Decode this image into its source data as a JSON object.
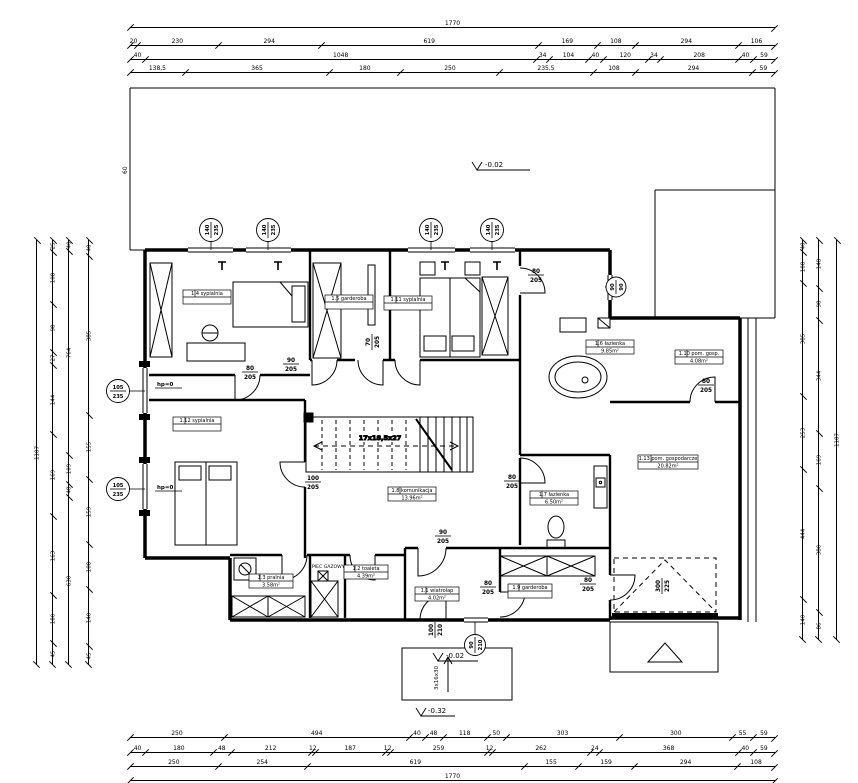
{
  "plan": {
    "rooms": [
      {
        "label": "1.4 sypialnia",
        "area": ""
      },
      {
        "label": "1.5 garderoba",
        "area": ""
      },
      {
        "label": "1.11 sypialnia",
        "area": ""
      },
      {
        "label": "1.6 łazienka",
        "area": "9.85m²"
      },
      {
        "label": "1.10 pom. gosp.",
        "area": "4.08m²"
      },
      {
        "label": "1.12 sypialnia",
        "area": ""
      },
      {
        "label": "1.8 komunikacja",
        "area": "13.96m²"
      },
      {
        "label": "1.7 łazienka",
        "area": "6.50m²"
      },
      {
        "label": "1.13 pom. gospodarcze",
        "area": "20.82m²"
      },
      {
        "label": "1.3 pralnia",
        "area": "3.58m²"
      },
      {
        "label": "1.2 toaleta",
        "area": "4.39m²"
      },
      {
        "label": "1.1 wiatrołap",
        "area": "4.02m²"
      },
      {
        "label": "1.9 garderoba",
        "area": ""
      }
    ],
    "doors": [
      {
        "top": "80",
        "bot": "205"
      },
      {
        "top": "90",
        "bot": "205"
      },
      {
        "top": "80",
        "bot": "205"
      },
      {
        "top": "80",
        "bot": "205"
      },
      {
        "top": "80",
        "bot": "205"
      },
      {
        "top": "100",
        "bot": "205"
      },
      {
        "top": "90",
        "bot": "205"
      },
      {
        "top": "80",
        "bot": "205"
      },
      {
        "top": "80",
        "bot": "205"
      },
      {
        "top": "70",
        "bot": "205"
      },
      {
        "top": "100",
        "bot": "210"
      },
      {
        "top": "300",
        "bot": "225"
      }
    ],
    "windows": [
      {
        "top": "140",
        "bot": "235"
      },
      {
        "top": "140",
        "bot": "235"
      },
      {
        "top": "140",
        "bot": "235"
      },
      {
        "top": "140",
        "bot": "235"
      },
      {
        "top": "105",
        "bot": "235"
      },
      {
        "top": "105",
        "bot": "235"
      },
      {
        "top": "90",
        "bot": "210"
      },
      {
        "top": "90",
        "bot": "90"
      }
    ],
    "levels": {
      "terrace": "-0.02",
      "entry": "-0.02",
      "outside": "-0.32"
    },
    "misc": {
      "stairs": "17x18,5x27",
      "steps": "3x16x30",
      "furnace": "PIEC GAZOWY",
      "hp": "hp=0",
      "dim60": "60"
    }
  },
  "dims": {
    "top": [
      [
        "1770"
      ],
      [
        "20",
        "230",
        "294",
        "619",
        "169",
        "108",
        "294",
        "106"
      ],
      [
        "40",
        "1048",
        "34",
        "104",
        "40",
        "120",
        "34",
        "208",
        "40",
        "59"
      ],
      [
        "138,5",
        "365",
        "180",
        "250",
        "235,5",
        "108",
        "294",
        "59"
      ]
    ],
    "bottom": [
      [
        "250",
        "494",
        "40",
        "48",
        "118",
        "50",
        "303",
        "300",
        "55",
        "59"
      ],
      [
        "40",
        "180",
        "48",
        "212",
        "12",
        "187",
        "12",
        "259",
        "12",
        "262",
        "24",
        "368",
        "40",
        "59"
      ],
      [
        "250",
        "254",
        "619",
        "155",
        "159",
        "294",
        "108"
      ],
      [
        "1770"
      ]
    ],
    "left": [
      [
        "1107"
      ],
      [
        "25",
        "108",
        "98",
        "27",
        "144",
        "169",
        "163",
        "100",
        "45"
      ],
      [
        "40",
        "764",
        "109",
        "48",
        "630"
      ],
      [
        "40",
        "385",
        "155",
        "159",
        "108",
        "140",
        "45"
      ]
    ],
    "right": [
      [
        "40",
        "108",
        "385",
        "253",
        "444",
        "140"
      ],
      [
        "148",
        "98",
        "344",
        "169",
        "380",
        "86"
      ],
      [
        "1107"
      ]
    ]
  }
}
